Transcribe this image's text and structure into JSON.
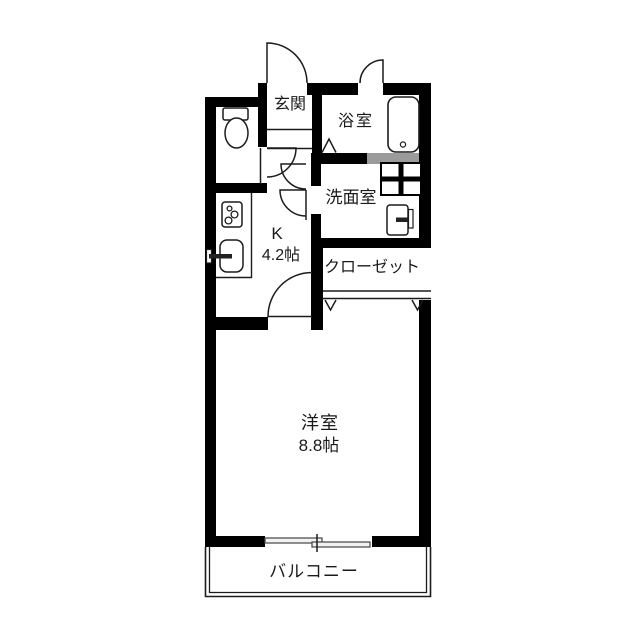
{
  "colors": {
    "wall": "#000000",
    "wall_gray": "#9b9b9b",
    "line": "#1c1c1c",
    "paper": "#ffffff",
    "window_fill": "#f2f2f2"
  },
  "rooms": {
    "genkan": {
      "label": "玄関"
    },
    "bath": {
      "label": "浴室"
    },
    "washroom": {
      "label": "洗面室"
    },
    "closet": {
      "label": "クローゼット"
    },
    "kitchen": {
      "label": "K",
      "size": "4.2帖"
    },
    "western_room": {
      "label": "洋室",
      "size": "8.8帖"
    },
    "balcony": {
      "label": "バルコニー"
    }
  },
  "fixtures": [
    "toilet",
    "bathtub",
    "washing-machine-pan",
    "vanity-sink",
    "stove",
    "kitchen-sink"
  ]
}
